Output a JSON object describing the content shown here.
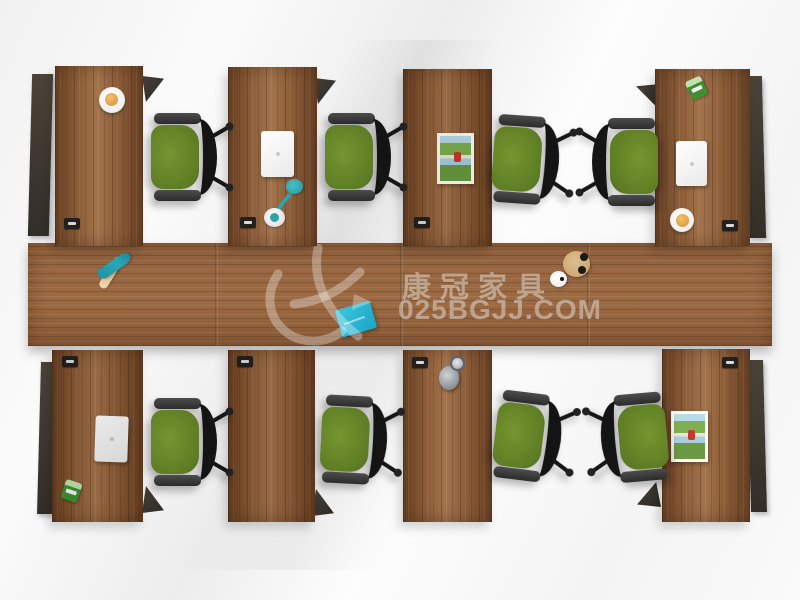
{
  "watermark": {
    "brand": "康冠家具",
    "site": "025BGJJ.COM",
    "logo": "ck-swoosh-logo"
  },
  "scene": {
    "workstation_count": 8,
    "chair_count": 8
  },
  "palette": {
    "wood_desk": "#8a5c38",
    "wood_dark": "#6e4527",
    "wood_light": "#a3744c",
    "wood_table": "#9c6b44",
    "wood_table_dark": "#8a5a36",
    "chair_green": "#75962f",
    "chair_green_dark": "#5d7c24",
    "chair_black": "#141414",
    "laptop": "#e9e9e9",
    "cup_orange": "#d98f3a",
    "plant_green": "#3f8f33",
    "photo_sky": "#b9dbe7",
    "photo_field": "#7fae53",
    "photo_red": "#c5392f",
    "lamp_teal": "#2fa3a8",
    "notebook_blue": "#1aa5c6",
    "teal_tool": "#2aa8b8",
    "wood_tan": "#c9a36a",
    "metal_gray": "#8f969c",
    "watermark": "rgba(255,255,255,0.42)"
  }
}
